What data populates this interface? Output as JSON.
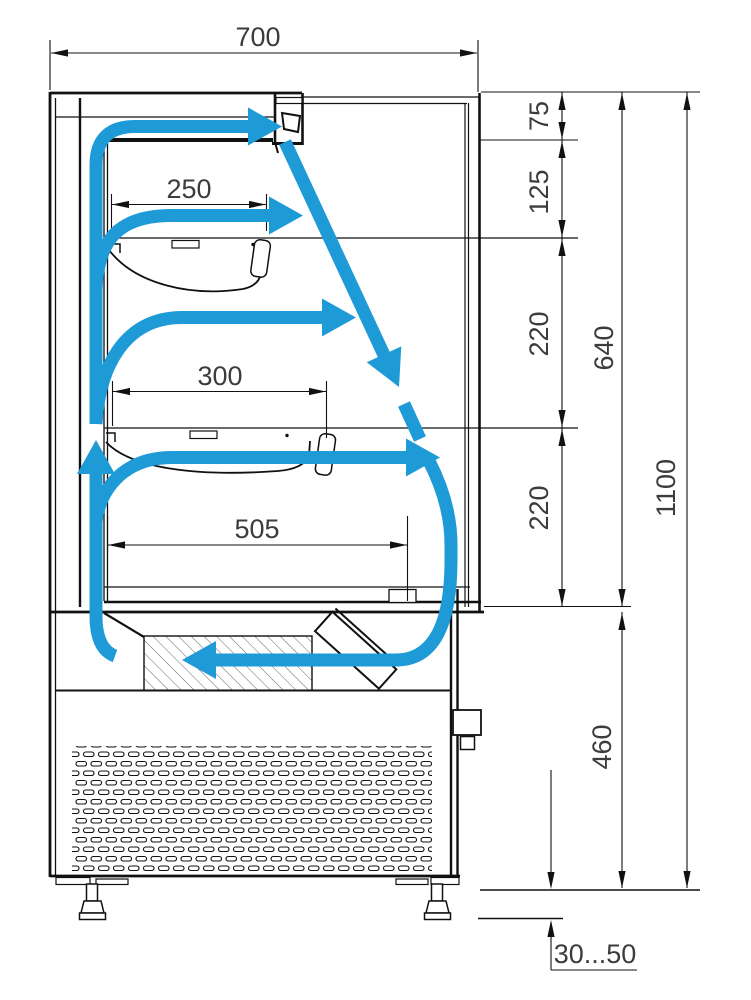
{
  "drawing": {
    "type": "technical-drawing",
    "subject": "open refrigerated display case - side section with air circulation",
    "colors": {
      "line": "#111111",
      "airflow": "#1E9BD7"
    },
    "dims": {
      "top_width": "700",
      "shelf1_depth": "250",
      "shelf2_depth": "300",
      "well_depth": "505",
      "canopy": "75",
      "gap_upper": "125",
      "tier1": "220",
      "tier2": "220",
      "opening_height": "640",
      "total_height": "1100",
      "base_height": "460",
      "feet_range": "30...50"
    }
  }
}
